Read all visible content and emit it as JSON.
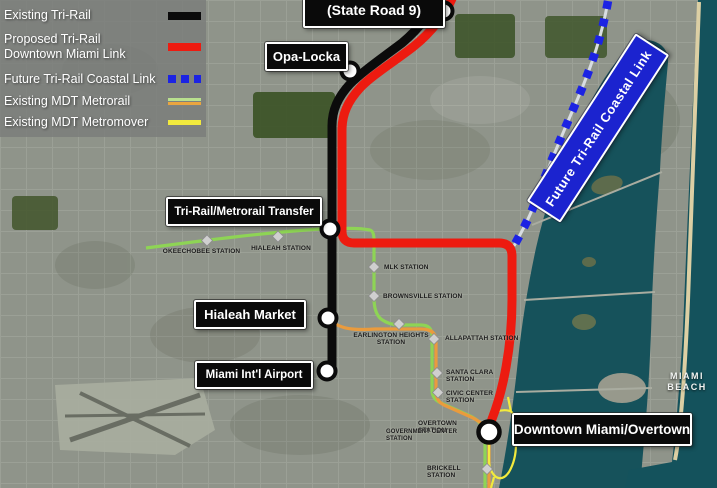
{
  "legend": {
    "items": [
      {
        "line1": "Existing Tri-Rail",
        "swatch": "black-solid",
        "color": "#0b0b0b"
      },
      {
        "line1": "Proposed Tri-Rail",
        "line2": "Downtown Miami Link",
        "swatch": "red-solid",
        "color": "#ed1b10"
      },
      {
        "line1": "Future Tri-Rail Coastal Link",
        "swatch": "blue-dashed",
        "color": "#1c23e3"
      },
      {
        "line1": "Existing MDT Metrorail",
        "swatch": "green-orange-double",
        "color": "#b9e08e",
        "color2": "#eaa53f"
      },
      {
        "line1": "Existing MDT Metromover",
        "swatch": "yellow-solid",
        "color": "#f2ea3d"
      }
    ]
  },
  "callouts": {
    "state_road_9": "(State Road 9)",
    "opa_locka": "Opa-Locka",
    "transfer": "Tri-Rail/Metrorail Transfer",
    "hialeah_market": "Hialeah Market",
    "airport": "Miami Int'l Airport",
    "downtown": "Downtown Miami/Overtown"
  },
  "coastal_banner": "Future Tri-Rail Coastal Link",
  "stations": [
    "OKEECHOBEE STATION",
    "HIALEAH STATION",
    "MLK STATION",
    "BROWNSVILLE STATION",
    "EARLINGTON HEIGHTS STATION",
    "ALLAPATTAH STATION",
    "SANTA CLARA STATION",
    "CIVIC CENTER STATION",
    "OVERTOWN STATION",
    "GOVERNMENT CENTER STATION",
    "BRICKELL STATION"
  ],
  "area_labels": {
    "miami_beach": "MIAMI BEACH",
    "downtown": "DOWNTOWN"
  },
  "colors": {
    "existing_tri_rail": "#0b0b0b",
    "proposed_link": "#ed1b10",
    "coastal_link": "#1c23e3",
    "metrorail_green": "#8ed455",
    "metrorail_orange": "#ea9b3d",
    "metromover_yellow": "#f2ea3d",
    "water": "#16525b",
    "land": "#8f948a",
    "beach_sand": "#dccfa4"
  }
}
